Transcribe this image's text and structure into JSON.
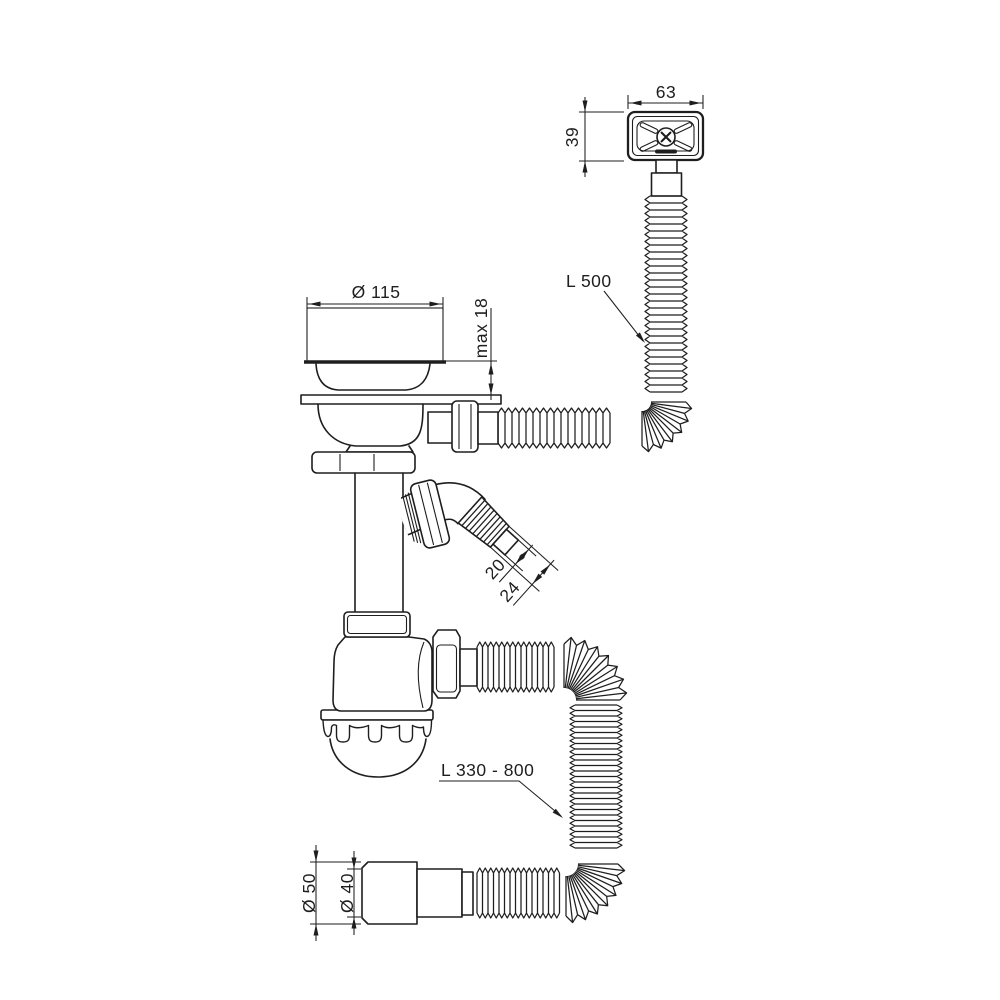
{
  "diagram": {
    "type": "technical-drawing",
    "subject": "sink-drain-siphon-kit-with-overflow",
    "colors": {
      "line": "#1e1e1e",
      "background": "#ffffff"
    },
    "labels": {
      "grate_width": "63",
      "grate_height": "39",
      "strainer_diameter": "Ø 115",
      "sink_max_thickness": "max 18",
      "overflow_hose_length": "L 500",
      "nozzle_inner_diameter": "20",
      "nozzle_outer_diameter": "24",
      "outlet_hose_length": "L 330 - 800",
      "outlet_outer_diameter": "Ø 50",
      "outlet_inner_diameter": "Ø 40"
    }
  }
}
